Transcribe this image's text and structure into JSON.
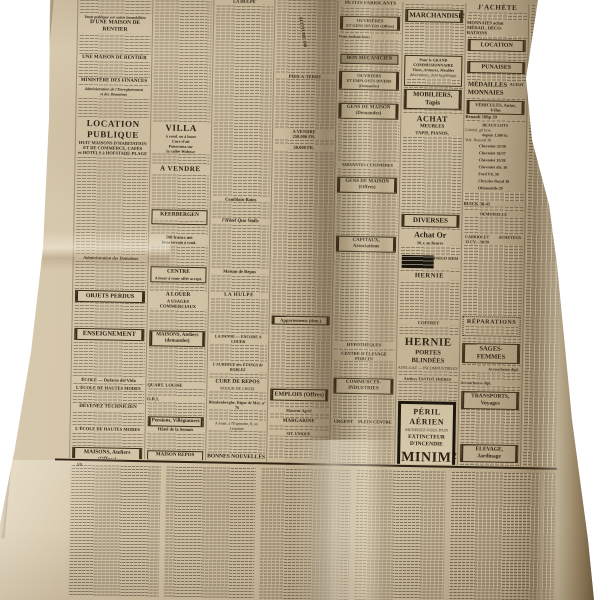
{
  "colors": {
    "backdrop": "#ffffff",
    "paper_light": "#d8cab0",
    "paper_mid": "#cfc0a2",
    "paper_shadow": "#93815f",
    "ink": "#261c10",
    "rule": "#3a2c18",
    "minimax_border": "#17110a"
  },
  "texts": {
    "colA": {
      "kicker": "Vente publique sur saisie immobilière",
      "maison_rentier_1": "D'UNE MAISON DE RENTIER",
      "maison_rentier_2": "UNE MAISON DE RENTIER",
      "ministere": "MINISTÈRE DES FINANCES",
      "admin_enregistrement_1": "Administration de l'Enregistrement",
      "admin_enregistrement_2": "et des Domaines",
      "location_publique": "LOCATION PUBLIQUE",
      "location_sub1": "HUIT MAISONS D'HABITATION",
      "location_sub2": "ET DE COMMERCE, CAFÉS",
      "location_sub3": "et HOTELS à HOFSTADE-PLAGE",
      "admin_domaines": "Administration des Domaines",
      "objets_perdus": "OBJETS PERDUS",
      "enseignement": "ENSEIGNEMENT",
      "ecole_line": "ÉCOLE — Dufaria del Vida",
      "hautes_modes_1": "L'ÉCOLE DE HAUTES MODES",
      "devenez_technicien": "DEVENEZ TECHNICIEN",
      "hautes_modes_2": "L'ÉCOLE DE HAUTES MODES",
      "maisons_ateliers_offres": "MAISONS, Ateliers (Offres)"
    },
    "colB": {
      "villa": "VILLA",
      "villa_l1": "à vend. ou à louer",
      "villa_l2": "Cure d'air",
      "villa_l3": "Panorama sur",
      "villa_l4": "la vallée Woluwe",
      "a_vendre": "A VENDRE",
      "keerbergen": "KEERBERGEN",
      "cinq_cents": "500 francs net",
      "terrain": "beau terrain à vend.",
      "centre": "CENTRE",
      "centre_sub": "A louer à toute offre accept.",
      "a_louer": "A LOUER",
      "usages": "A USAGES COMMERCIAUX",
      "maisons_ateliers_dem": "MAISONS, Ateliers (demandes)",
      "quart_louise": "QUART. LOUISE",
      "ori": "O.R.I.",
      "pensions": "Pensions, Villégiatures",
      "hotel_semois": "Hôtel de la Semois",
      "maison_repos_box": "MAISON REPOS"
    },
    "colC": {
      "la_hulpe_top": "LA HULPE",
      "comblain": "Comblain-Bains",
      "quo_vadis": "l'Hôtel Quo Vadis",
      "maison_de_repos": "Maison de Repos",
      "la_hulpe": "LA HULPE",
      "la_panne": "LA PANNE — ENCORE A LOUER",
      "auberge": "L'AUBERGE des ÉTANGS de BORLEZ",
      "cure_de_repos": "CURE DE REPOS",
      "sejour": "SÉJOUR DE CHOIX",
      "blankenberghe": "Blankenberghe, Digue de Mer, n° 76",
      "espinette": "A louer, à l'Espinette, 8, av. Lequime",
      "bonnes_nouvelles": "BONNES NOUVELLES",
      "bonnes_sub": "pour Bureau de Voyage et Tourisme"
    },
    "colD": {
      "pied_a_terre": "PIED-A-TERRE",
      "altitude": "ALTITUDE 100",
      "a_vendre": "A VENDRE",
      "prix1": "250.000 FR.",
      "prix2": "50.000 FR.",
      "appartements": "Appartements (dem.)",
      "emplois": "EMPLOIS (Offres)",
      "masseur": "Masseur Agréé",
      "margarine": "MARGARINE",
      "sit_unique": "SIT. UNIQUE"
    },
    "colE": {
      "petits_fabricants": "PETITS FABRICANTS",
      "ouvrieres_1": "OUVRIÈRES",
      "ouvrieres_2": "ET GENS DIVERS (Offres)",
      "embauchons": "Nous embauchons :",
      "bon_mecanicien": "BON MÉCANICIEN",
      "ouvriers_1": "OUVRIERS",
      "ouvriers_2": "ET EMPLOYÉS DIVERS (Demandes)",
      "gens_maison_dem": "GENS DE MAISON (Demandes)",
      "servantes": "SERVANTES-CUISINIÈRES",
      "gens_maison_off": "GENS DE MAISON (Offres)",
      "capitaux": "CAPITAUX, Associations",
      "hypotheques": "HYPOTHÈQUES",
      "elevage_porcin": "CENTRE D'ÉLEVAGE PORCIN",
      "commerces": "COMMERCES-INDUSTRIES",
      "urgent": "URGENT",
      "plein_centre": "PLEIN CENTRE",
      "placement": "UN PLACEMENT «DOLLARS»"
    },
    "colF": {
      "marchandises": "MARCHANDISES",
      "grand_comm_1": "Pour le GRAND COMMISSIONNAIRE",
      "grand_comm_2": "Vieux, Armures, Meubles",
      "grand_comm_3": "décorations, dont hygiénique",
      "mobiliers": "MOBILIERS, Tapis",
      "achat": "ACHAT",
      "meubles": "MEUBLES",
      "tapis_pianos": "TAPIS, PIANOS,",
      "diverses": "DIVERSES",
      "achat_or": "Achat Or",
      "rue_beurre": "38, r. au Beurre",
      "frigo": "FRIGO SIEM",
      "hernie_1": "HERNIE",
      "coffret": "COFFRET",
      "hernie_2": "HERNIE",
      "portes_blindees": "PORTES BLINDÉES",
      "anti_gaz": "ANTI-GAZ — INCOMBUSTIBLES",
      "tantot": "Ateliers TANTOT FRÈRES",
      "minimax_l1": "PÉRIL AÉRIEN",
      "minimax_l2": "MUNISSEZ-VOUS D'UN",
      "minimax_l3": "EXTINCTEUR D'INCENDIE",
      "minimax_l4": "MINIMAX",
      "minimax_l5": "11, rue du Pépin, Bruxelles",
      "minimax_l6": "(Téléphone : 12.58.58)"
    },
    "colG": {
      "jachete": "J'ACHÈTE",
      "monnaies_1": "MONNAIES achat",
      "monnaies_2": "MÉDAIL. DÉCO-",
      "monnaies_3": "RATIONS",
      "location": "LOCATION",
      "punaises": "PUNAISES",
      "medailles": "MÉDAILLES",
      "monnaies": "MONNAIES",
      "achat_small": "ACHAT",
      "vehicules": "VÉHICULES, Autos, Vélos",
      "renault": "Renault 10hp 39",
      "beaux_lots": "BEAUX LOTS",
      "cabriolet_luxe": "Cabriol. gd luxe",
      "depuis": "depuis 1.500 fr.",
      "voit_renault": "Voit. Renault 38",
      "cars": [
        "Chevrolet 35/38",
        "Chevrolet 36/37",
        "Chevrolet 35/38",
        "Chevrolet dir. 38",
        "Ford V8, 38",
        "Chrysler Royal 38",
        "Oldsmobile 39"
      ],
      "buick": "BUICK 38-41",
      "demoiselle": "DEMOISELLE",
      "cabriolet": "CABRIOLET",
      "douze_cv": "12 CV. - 38/39",
      "acheteur": "ACHETEUR",
      "reparations": "RÉPARATIONS",
      "sages_femmes": "SAGES-FEMMES",
      "accoucheuse_1": "Accoucheuse dipl.",
      "accoucheuse_2": "Accoucheuse dipl.",
      "transports": "TRANSPORTS, Voyages",
      "elevage": "ÉLEVAGE, Jardinage"
    },
    "feuilleton": {
      "number": "59"
    }
  }
}
